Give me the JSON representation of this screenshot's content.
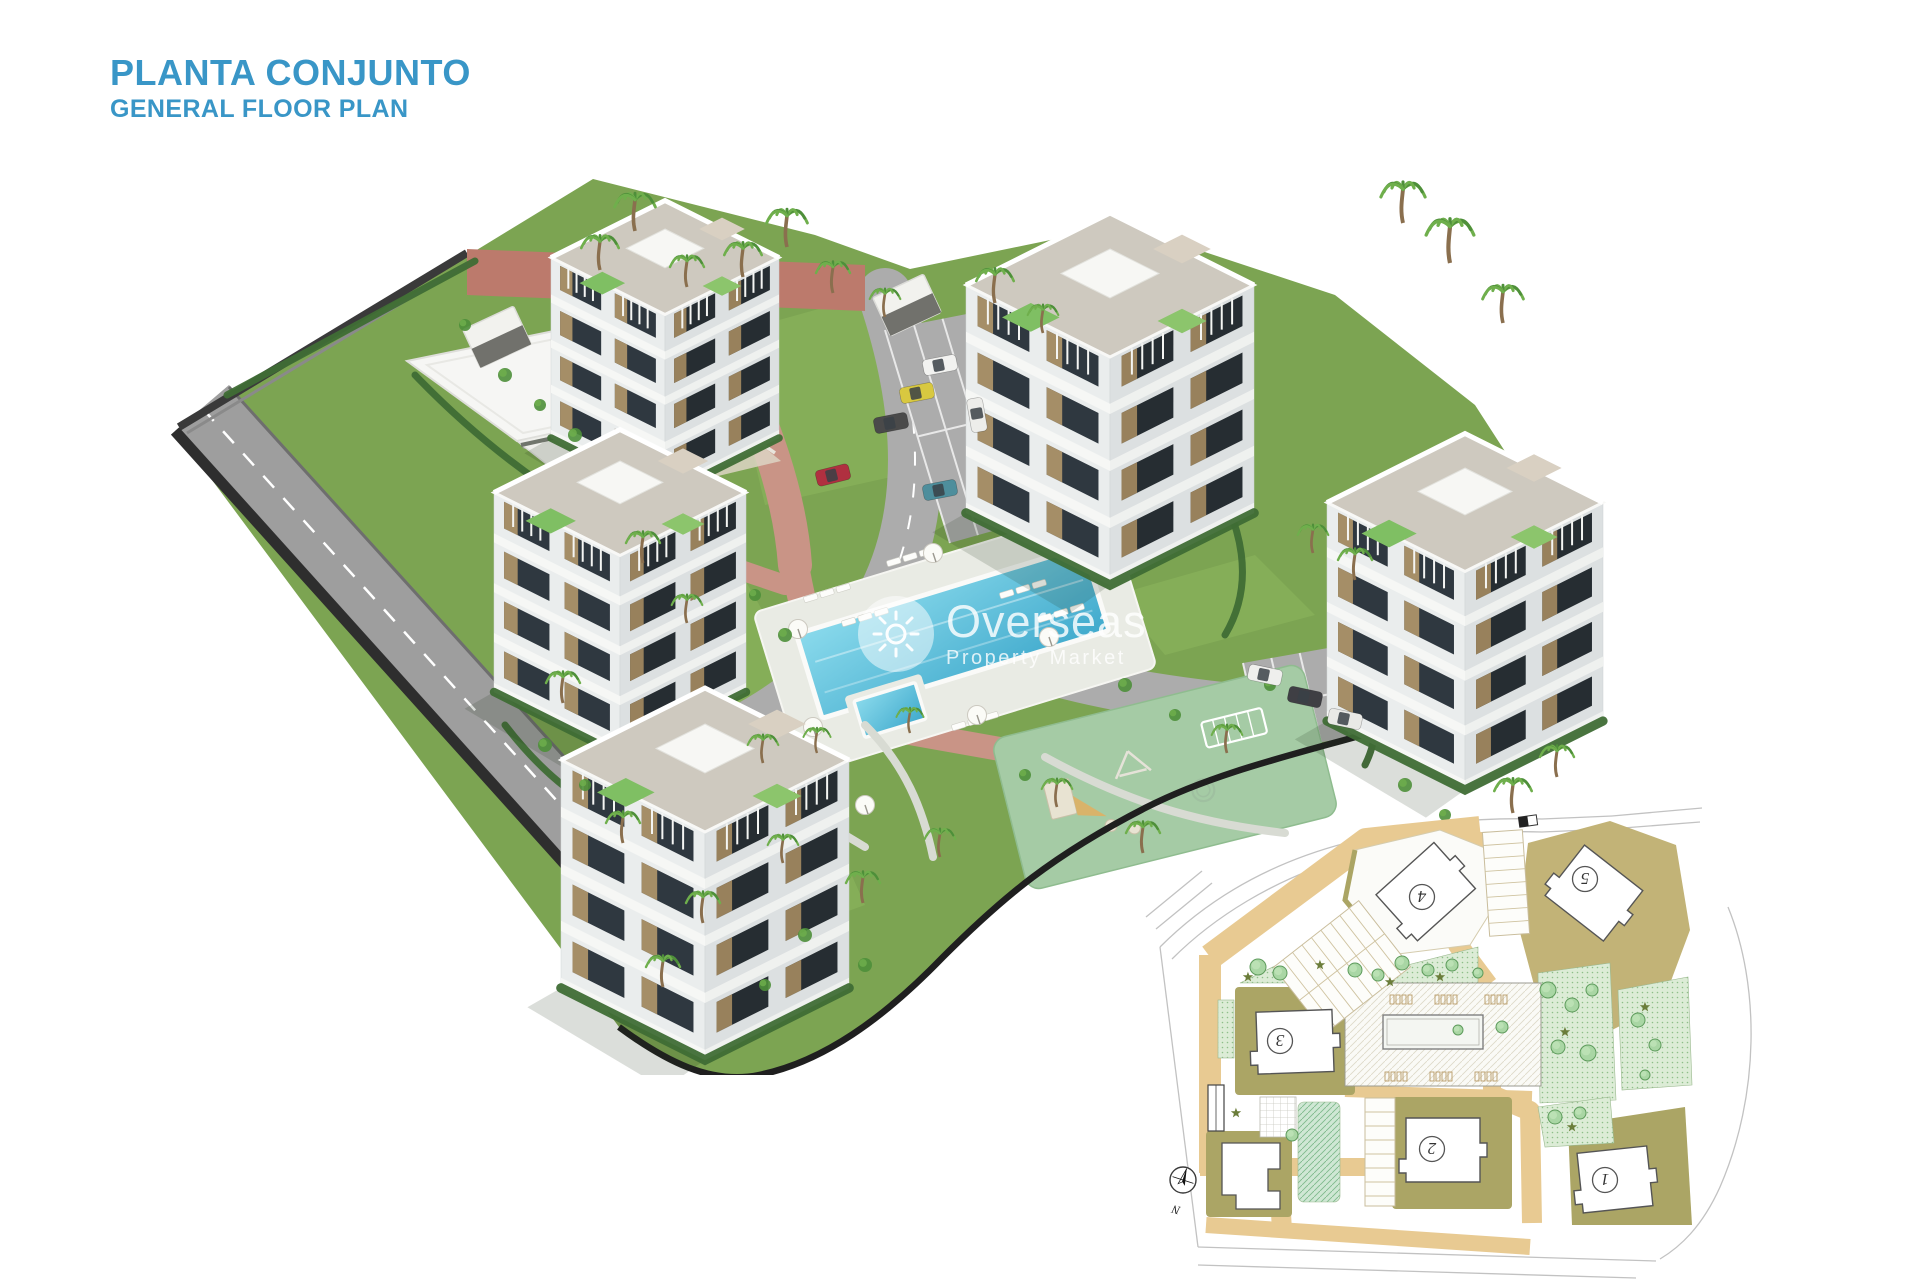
{
  "header": {
    "title": "PLANTA CONJUNTO",
    "subtitle": "GENERAL FLOOR PLAN"
  },
  "watermark": {
    "brand": "Overseas",
    "tagline": "Property Market",
    "icon": "sun-icon"
  },
  "inset": {
    "compass_label": "N",
    "buildings": [
      {
        "label": "1"
      },
      {
        "label": "2"
      },
      {
        "label": "3"
      },
      {
        "label": "4"
      },
      {
        "label": "5"
      }
    ]
  },
  "colors": {
    "title_blue": "#3996C7",
    "lawn": "#7CA452",
    "lawn_light": "#8DB65C",
    "lawn_dark": "#6F9A47",
    "hedge": "#3F6D35",
    "asphalt": "#9E9E9E",
    "asphalt_dark": "#2E2E2E",
    "road_inner": "#ACACAC",
    "brick": "#BC7A6C",
    "brick_light": "#C99486",
    "pool_blue": "#3FA9CC",
    "pool_blue_light": "#7FD4E8",
    "playground": "#A5CBA5",
    "slide_tan": "#D9B36A",
    "building_white": "#F6F6F4",
    "face_light": "#EAEDED",
    "face_shade": "#DCE0E1",
    "roof_deck": "#CEC9BF",
    "window_dark": "#2F3840",
    "wood": "#B3986B",
    "wall_dark": "#1F1F1F",
    "palm_green": "#4E8F3A",
    "palm_light": "#6FAF4C",
    "trunk": "#8A6F4E",
    "inset_tan": "#E8CA92",
    "inset_olive": "#ABA565",
    "inset_khaki": "#C2B377",
    "inset_green": "#DCECD6",
    "inset_tree": "#A9D6A4",
    "inset_tree_dark": "#5E9B5C",
    "inset_shrub": "#6B7D3A",
    "inset_outline": "#555555"
  }
}
